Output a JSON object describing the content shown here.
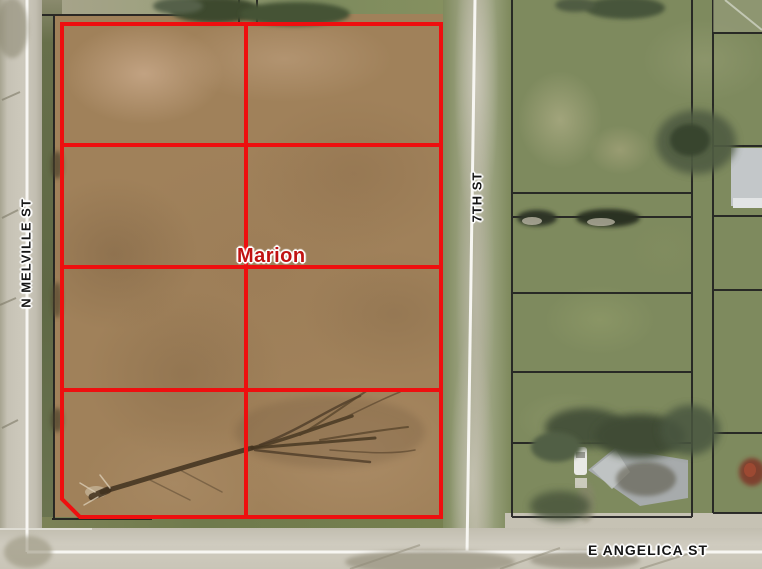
{
  "map": {
    "city_label": "Marion",
    "streets": [
      {
        "name": "N MELVILLE ST",
        "orientation": "vertical"
      },
      {
        "name": "7TH ST",
        "orientation": "vertical"
      },
      {
        "name": "E ANGELICA ST",
        "orientation": "horizontal"
      }
    ],
    "parcel_overlay": {
      "grid_columns": 2,
      "grid_rows": 4,
      "boundary_color": "#ee0f0f"
    },
    "colors": {
      "city_label": "#c01212",
      "street_label": "#151515",
      "road_centerline": "#f7f6f2",
      "parcel_line_black": "#1f1f1f",
      "dirt_field": "#a0815a",
      "grass": "#7e8a5e",
      "road_surface": "#cbc7bb"
    }
  }
}
